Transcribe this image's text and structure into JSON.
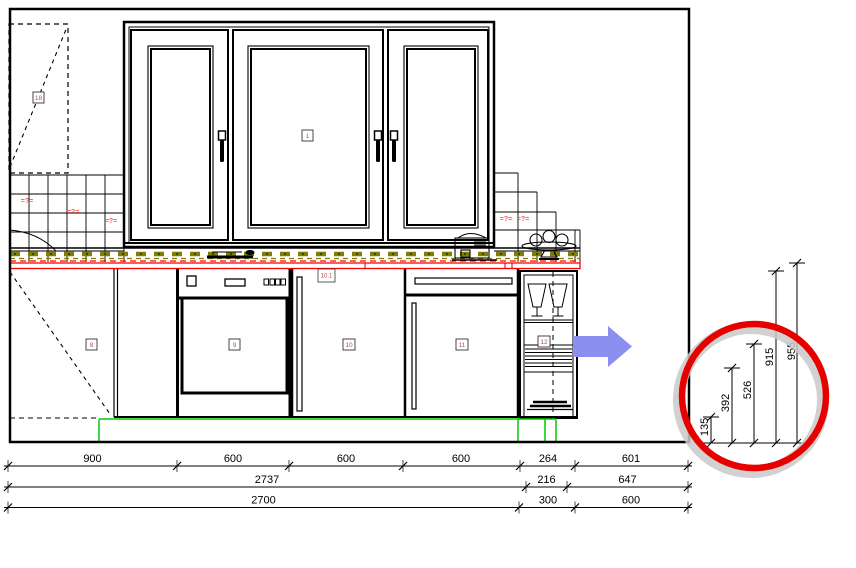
{
  "drawing_labels": {
    "window": "18",
    "wall_cabinet": "1",
    "corner_base": "8",
    "dishwasher": "9",
    "base_cabinet": "10",
    "base_cabinet_top": "10.1",
    "tall_cabinet": "11",
    "shelf_unit": "12"
  },
  "tile_marks": [
    "=?=",
    "=?=",
    "=?=",
    "=?=",
    "=?="
  ],
  "dims": {
    "row1": [
      "900",
      "600",
      "600",
      "600",
      "264",
      "601"
    ],
    "row2": [
      "2737",
      "216",
      "647"
    ],
    "row3": [
      "2700",
      "300",
      "600"
    ],
    "vertical": [
      "135",
      "392",
      "526",
      "915",
      "955"
    ]
  },
  "colors": {
    "outline": "#000000",
    "tile_mark_red": "#ff5555",
    "counter_red": "#ff0000",
    "olive": "#808000",
    "plinth_green": "#00cc00",
    "arrow_blue": "#8a8ff0",
    "annotation_red": "#e60000",
    "annotation_shadow": "#c9c9c9"
  }
}
